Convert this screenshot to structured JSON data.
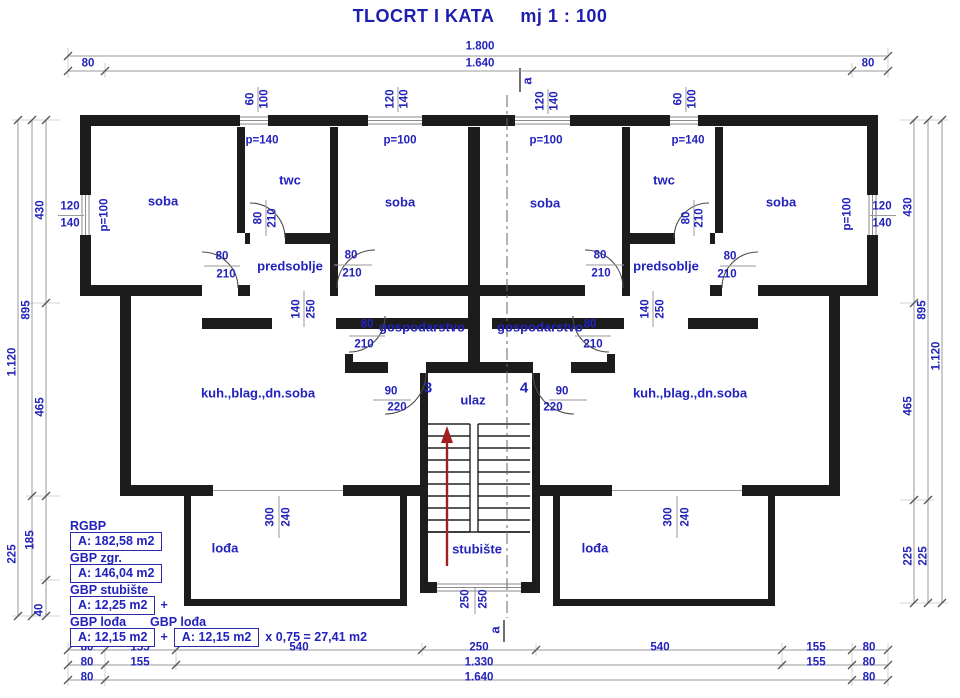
{
  "title": {
    "main": "TLOCRT I KATA",
    "scale": "mj 1 : 100"
  },
  "accent_color": "#2222bc",
  "wall_color": "#1c1c1c",
  "arrow_color": "#a02020",
  "areas": {
    "rgbp_label": "RGBP",
    "rgbp_value": "A: 182,58 m2",
    "gbp_zgr_label": "GBP zgr.",
    "gbp_zgr_value": "A: 146,04 m2",
    "gbp_stubiste_label": "GBP stubište",
    "gbp_stubiste_value": "A: 12,25 m2",
    "plus": "+",
    "gbp_lodja_label": "GBP lođa",
    "gbp_lodja2_label": "GBP lođa",
    "gbp_lodja_value": "A: 12,15 m2",
    "gbp_lodja2_value": "A: 12,15 m2",
    "formula_suffix": "x 0,75 = 27,41 m2"
  },
  "labels": [
    {
      "name": "room-soba-1",
      "text": "soba",
      "x": 163,
      "y": 201,
      "cls": "room"
    },
    {
      "name": "room-twc-1",
      "text": "twc",
      "x": 290,
      "y": 180,
      "cls": "room"
    },
    {
      "name": "room-soba-2",
      "text": "soba",
      "x": 400,
      "y": 202,
      "cls": "room"
    },
    {
      "name": "room-soba-3",
      "text": "soba",
      "x": 545,
      "y": 203,
      "cls": "room"
    },
    {
      "name": "room-twc-2",
      "text": "twc",
      "x": 664,
      "y": 180,
      "cls": "room"
    },
    {
      "name": "room-soba-4",
      "text": "soba",
      "x": 781,
      "y": 202,
      "cls": "room"
    },
    {
      "name": "room-predsoblje-1",
      "text": "predsoblje",
      "x": 290,
      "y": 266,
      "cls": "room"
    },
    {
      "name": "room-predsoblje-2",
      "text": "predsoblje",
      "x": 666,
      "y": 266,
      "cls": "room"
    },
    {
      "name": "room-gospodarstvo-1",
      "text": "gospodarstvo",
      "x": 422,
      "y": 327,
      "cls": "room"
    },
    {
      "name": "room-gospodarstvo-2",
      "text": "gospodarstvo",
      "x": 540,
      "y": 327,
      "cls": "room"
    },
    {
      "name": "room-kuh-1",
      "text": "kuh.,blag.,dn.soba",
      "x": 258,
      "y": 393,
      "cls": "room"
    },
    {
      "name": "room-kuh-2",
      "text": "kuh.,blag.,dn.soba",
      "x": 690,
      "y": 393,
      "cls": "room"
    },
    {
      "name": "room-ulaz",
      "text": "ulaz",
      "x": 473,
      "y": 400,
      "cls": "room"
    },
    {
      "name": "room-lodja-1",
      "text": "lođa",
      "x": 225,
      "y": 548,
      "cls": "room"
    },
    {
      "name": "room-lodja-2",
      "text": "lođa",
      "x": 595,
      "y": 548,
      "cls": "room"
    },
    {
      "name": "room-stubiste",
      "text": "stubište",
      "x": 477,
      "y": 549,
      "cls": "room"
    },
    {
      "name": "apartment-number-3",
      "text": "3",
      "x": 428,
      "y": 388,
      "cls": "apt"
    },
    {
      "name": "apartment-number-4",
      "text": "4",
      "x": 524,
      "y": 388,
      "cls": "apt"
    },
    {
      "name": "section-a-top",
      "text": "a",
      "x": 527,
      "y": 81,
      "rot": 1,
      "cls": "sec"
    },
    {
      "name": "section-a-bottom",
      "text": "a",
      "x": 495,
      "y": 630,
      "rot": 1,
      "cls": "sec"
    },
    {
      "name": "dim-top-1800",
      "text": "1.800",
      "x": 480,
      "y": 47
    },
    {
      "name": "dim-top-80-l",
      "text": "80",
      "x": 88,
      "y": 64
    },
    {
      "name": "dim-top-1640",
      "text": "1.640",
      "x": 480,
      "y": 64
    },
    {
      "name": "dim-top-80-r",
      "text": "80",
      "x": 868,
      "y": 64
    },
    {
      "name": "dim-bottom1-80-l",
      "text": "80",
      "x": 87,
      "y": 648
    },
    {
      "name": "dim-bottom1-155-l",
      "text": "155",
      "x": 140,
      "y": 648
    },
    {
      "name": "dim-bottom1-540-l",
      "text": "540",
      "x": 299,
      "y": 648
    },
    {
      "name": "dim-bottom1-250",
      "text": "250",
      "x": 479,
      "y": 648
    },
    {
      "name": "dim-bottom1-540-r",
      "text": "540",
      "x": 660,
      "y": 648
    },
    {
      "name": "dim-bottom1-155-r",
      "text": "155",
      "x": 816,
      "y": 648
    },
    {
      "name": "dim-bottom1-80-r",
      "text": "80",
      "x": 869,
      "y": 648
    },
    {
      "name": "dim-bottom2-80-l",
      "text": "80",
      "x": 87,
      "y": 663
    },
    {
      "name": "dim-bottom2-155-l",
      "text": "155",
      "x": 140,
      "y": 663
    },
    {
      "name": "dim-bottom2-1330",
      "text": "1.330",
      "x": 479,
      "y": 663
    },
    {
      "name": "dim-bottom2-155-r",
      "text": "155",
      "x": 816,
      "y": 663
    },
    {
      "name": "dim-bottom2-80-r",
      "text": "80",
      "x": 869,
      "y": 663
    },
    {
      "name": "dim-bottom3-80-l",
      "text": "80",
      "x": 87,
      "y": 678
    },
    {
      "name": "dim-bottom3-1640",
      "text": "1.640",
      "x": 479,
      "y": 678
    },
    {
      "name": "dim-bottom3-80-r",
      "text": "80",
      "x": 869,
      "y": 678
    },
    {
      "name": "dim-left-430",
      "text": "430",
      "x": 41,
      "y": 210,
      "rot": 1
    },
    {
      "name": "dim-left-895",
      "text": "895",
      "x": 27,
      "y": 310,
      "rot": 1
    },
    {
      "name": "dim-left-1120",
      "text": "1.120",
      "x": 13,
      "y": 362,
      "rot": 1
    },
    {
      "name": "dim-left-465",
      "text": "465",
      "x": 41,
      "y": 407,
      "rot": 1
    },
    {
      "name": "dim-left-185",
      "text": "185",
      "x": 31,
      "y": 540,
      "rot": 1
    },
    {
      "name": "dim-left-225",
      "text": "225",
      "x": 13,
      "y": 554,
      "rot": 1
    },
    {
      "name": "dim-left-40",
      "text": "40",
      "x": 40,
      "y": 610,
      "rot": 1
    },
    {
      "name": "dim-right-430",
      "text": "430",
      "x": 909,
      "y": 207,
      "rot": 1
    },
    {
      "name": "dim-right-895",
      "text": "895",
      "x": 923,
      "y": 310,
      "rot": 1
    },
    {
      "name": "dim-right-1120",
      "text": "1.120",
      "x": 937,
      "y": 356,
      "rot": 1
    },
    {
      "name": "dim-right-465",
      "text": "465",
      "x": 909,
      "y": 406,
      "rot": 1
    },
    {
      "name": "dim-right-225-a",
      "text": "225",
      "x": 909,
      "y": 556,
      "rot": 1
    },
    {
      "name": "dim-right-225-b",
      "text": "225",
      "x": 924,
      "y": 556,
      "rot": 1
    },
    {
      "name": "win-twc1-60",
      "text": "60",
      "x": 251,
      "y": 99,
      "rot": 1
    },
    {
      "name": "win-twc1-100",
      "text": "100",
      "x": 265,
      "y": 99,
      "rot": 1
    },
    {
      "name": "win-twc1-parapet",
      "text": "p=140",
      "x": 262,
      "y": 141
    },
    {
      "name": "win-soba2-120",
      "text": "120",
      "x": 391,
      "y": 99,
      "rot": 1
    },
    {
      "name": "win-soba2-140",
      "text": "140",
      "x": 405,
      "y": 99,
      "rot": 1
    },
    {
      "name": "win-soba2-parapet",
      "text": "p=100",
      "x": 400,
      "y": 141
    },
    {
      "name": "win-soba3-120",
      "text": "120",
      "x": 541,
      "y": 101,
      "rot": 1
    },
    {
      "name": "win-soba3-140",
      "text": "140",
      "x": 555,
      "y": 101,
      "rot": 1
    },
    {
      "name": "win-soba3-parapet",
      "text": "p=100",
      "x": 546,
      "y": 141
    },
    {
      "name": "win-twc2-60",
      "text": "60",
      "x": 679,
      "y": 99,
      "rot": 1
    },
    {
      "name": "win-twc2-100",
      "text": "100",
      "x": 693,
      "y": 99,
      "rot": 1
    },
    {
      "name": "win-twc2-parapet",
      "text": "p=140",
      "x": 688,
      "y": 141
    },
    {
      "name": "win-left-120",
      "text": "120",
      "x": 70,
      "y": 207
    },
    {
      "name": "win-left-140",
      "text": "140",
      "x": 70,
      "y": 224
    },
    {
      "name": "win-left-parapet",
      "text": "p=100",
      "x": 105,
      "y": 215,
      "rot": 1
    },
    {
      "name": "win-right-120",
      "text": "120",
      "x": 882,
      "y": 207
    },
    {
      "name": "win-right-140",
      "text": "140",
      "x": 882,
      "y": 224
    },
    {
      "name": "win-right-parapet",
      "text": "p=100",
      "x": 848,
      "y": 214,
      "rot": 1
    },
    {
      "name": "door-twc1-80",
      "text": "80",
      "x": 259,
      "y": 218,
      "rot": 1
    },
    {
      "name": "door-twc1-210",
      "text": "210",
      "x": 273,
      "y": 218,
      "rot": 1
    },
    {
      "name": "door-soba1-80",
      "text": "80",
      "x": 222,
      "y": 257
    },
    {
      "name": "door-soba1-210",
      "text": "210",
      "x": 226,
      "y": 275
    },
    {
      "name": "door-soba2-80",
      "text": "80",
      "x": 351,
      "y": 256
    },
    {
      "name": "door-soba2-210",
      "text": "210",
      "x": 352,
      "y": 274
    },
    {
      "name": "pass-left-140",
      "text": "140",
      "x": 297,
      "y": 309,
      "rot": 1
    },
    {
      "name": "pass-left-250",
      "text": "250",
      "x": 312,
      "y": 309,
      "rot": 1
    },
    {
      "name": "door-gosp1-80",
      "text": "80",
      "x": 367,
      "y": 325
    },
    {
      "name": "door-gosp1-210",
      "text": "210",
      "x": 364,
      "y": 345
    },
    {
      "name": "door-twc2-80",
      "text": "80",
      "x": 687,
      "y": 218,
      "rot": 1
    },
    {
      "name": "door-twc2-210",
      "text": "210",
      "x": 700,
      "y": 218,
      "rot": 1
    },
    {
      "name": "door-soba3-80",
      "text": "80",
      "x": 600,
      "y": 256
    },
    {
      "name": "door-soba3-210",
      "text": "210",
      "x": 601,
      "y": 274
    },
    {
      "name": "door-soba4-80",
      "text": "80",
      "x": 730,
      "y": 257
    },
    {
      "name": "door-soba4-210",
      "text": "210",
      "x": 727,
      "y": 275
    },
    {
      "name": "pass-right-140",
      "text": "140",
      "x": 646,
      "y": 309,
      "rot": 1
    },
    {
      "name": "pass-right-250",
      "text": "250",
      "x": 661,
      "y": 309,
      "rot": 1
    },
    {
      "name": "door-gosp2-80",
      "text": "80",
      "x": 590,
      "y": 325
    },
    {
      "name": "door-gosp2-210",
      "text": "210",
      "x": 593,
      "y": 345
    },
    {
      "name": "door-entry3-90",
      "text": "90",
      "x": 391,
      "y": 392
    },
    {
      "name": "door-entry3-220",
      "text": "220",
      "x": 397,
      "y": 408
    },
    {
      "name": "door-entry4-90",
      "text": "90",
      "x": 562,
      "y": 392
    },
    {
      "name": "door-entry4-220",
      "text": "220",
      "x": 553,
      "y": 408
    },
    {
      "name": "open-lodja1-300",
      "text": "300",
      "x": 271,
      "y": 517,
      "rot": 1
    },
    {
      "name": "open-lodja1-240",
      "text": "240",
      "x": 287,
      "y": 517,
      "rot": 1
    },
    {
      "name": "open-lodja2-300",
      "text": "300",
      "x": 669,
      "y": 517,
      "rot": 1
    },
    {
      "name": "open-lodja2-240",
      "text": "240",
      "x": 686,
      "y": 517,
      "rot": 1
    },
    {
      "name": "win-stair-250-a",
      "text": "250",
      "x": 466,
      "y": 599,
      "rot": 1
    },
    {
      "name": "win-stair-250-b",
      "text": "250",
      "x": 484,
      "y": 599,
      "rot": 1
    }
  ]
}
